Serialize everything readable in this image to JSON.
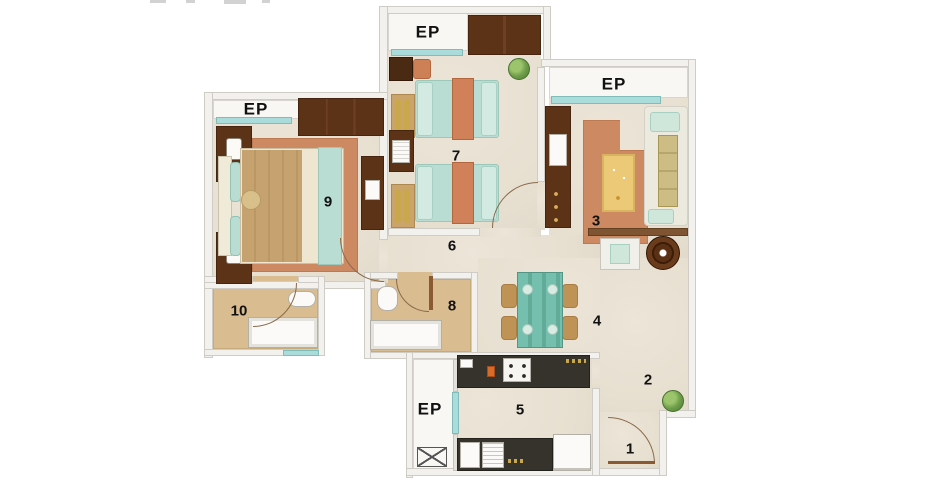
{
  "floor_plan": {
    "type": "apartment-floor-plan",
    "labels": {
      "ep": "EP",
      "room1": "1",
      "room2": "2",
      "room3": "3",
      "room4": "4",
      "room5": "5",
      "room6": "6",
      "room7": "7",
      "room8": "8",
      "room9": "9",
      "room10": "10"
    },
    "ep_label_count": 4,
    "colors": {
      "background": "#ffffff",
      "wall_fill": "#f2f1ed",
      "wall_line": "#cfccc5",
      "floor_cream": "#e9e2d4",
      "bathroom_floor_tan": "#d9bd90",
      "rug_terracotta": "#cd8a62",
      "bedding_mint": "#b9ddd3",
      "bedding_orange": "#d0815a",
      "blanket_tan": "#c6a271",
      "wood_dark_brown": "#5d3318",
      "window_teal": "#a9dcda",
      "kitchen_counter_dark": "#35332b",
      "dining_table_teal": "#74bfae",
      "chair_tan": "#bf9355",
      "plant_green": "#6f9e4a",
      "label_text": "#111111"
    }
  }
}
